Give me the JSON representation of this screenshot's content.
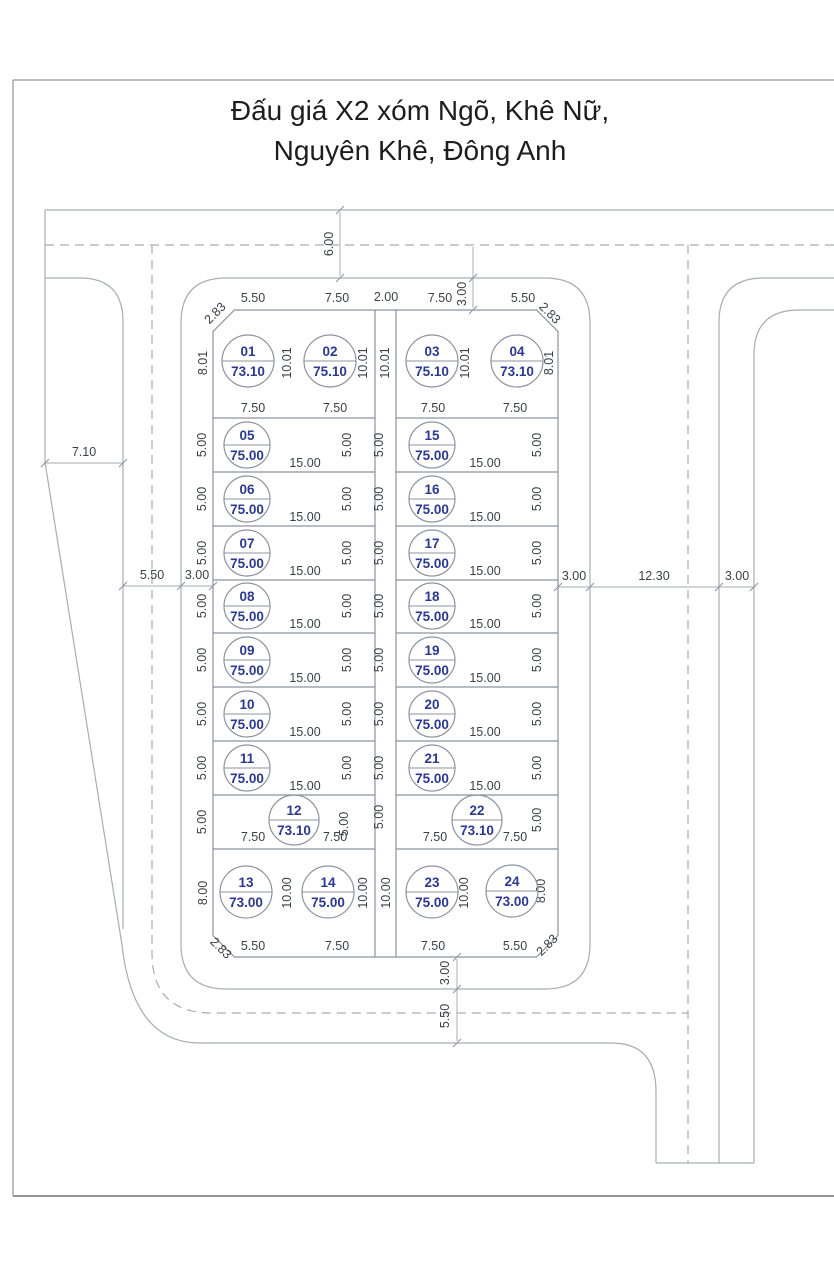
{
  "title": {
    "line1": "Đấu giá X2 xóm Ngõ, Khê Nữ,",
    "line2": "Nguyên Khê, Đông Anh"
  },
  "colors": {
    "plot_label": "#2b3990",
    "dim_text": "#3b4046",
    "line_gray": "#a6adb5",
    "paper": "#ffffff"
  },
  "dims": {
    "v283": "2.83",
    "v550": "5.50",
    "v750": "7.50",
    "v200": "2.00",
    "v300": "3.00",
    "v600": "6.00",
    "v710": "7.10",
    "v1230": "12.30",
    "v500": "5.00",
    "v1500": "15.00",
    "v801": "8.01",
    "v1001": "10.01",
    "v800": "8.00",
    "v1000": "10.00"
  },
  "plots": [
    {
      "id": "01",
      "area": "73.10"
    },
    {
      "id": "02",
      "area": "75.10"
    },
    {
      "id": "03",
      "area": "75.10"
    },
    {
      "id": "04",
      "area": "73.10"
    },
    {
      "id": "05",
      "area": "75.00"
    },
    {
      "id": "06",
      "area": "75.00"
    },
    {
      "id": "07",
      "area": "75.00"
    },
    {
      "id": "08",
      "area": "75.00"
    },
    {
      "id": "09",
      "area": "75.00"
    },
    {
      "id": "10",
      "area": "75.00"
    },
    {
      "id": "11",
      "area": "75.00"
    },
    {
      "id": "12",
      "area": "73.10"
    },
    {
      "id": "13",
      "area": "73.00"
    },
    {
      "id": "14",
      "area": "75.00"
    },
    {
      "id": "15",
      "area": "75.00"
    },
    {
      "id": "16",
      "area": "75.00"
    },
    {
      "id": "17",
      "area": "75.00"
    },
    {
      "id": "18",
      "area": "75.00"
    },
    {
      "id": "19",
      "area": "75.00"
    },
    {
      "id": "20",
      "area": "75.00"
    },
    {
      "id": "21",
      "area": "75.00"
    },
    {
      "id": "22",
      "area": "73.10"
    },
    {
      "id": "23",
      "area": "75.00"
    },
    {
      "id": "24",
      "area": "73.00"
    }
  ]
}
